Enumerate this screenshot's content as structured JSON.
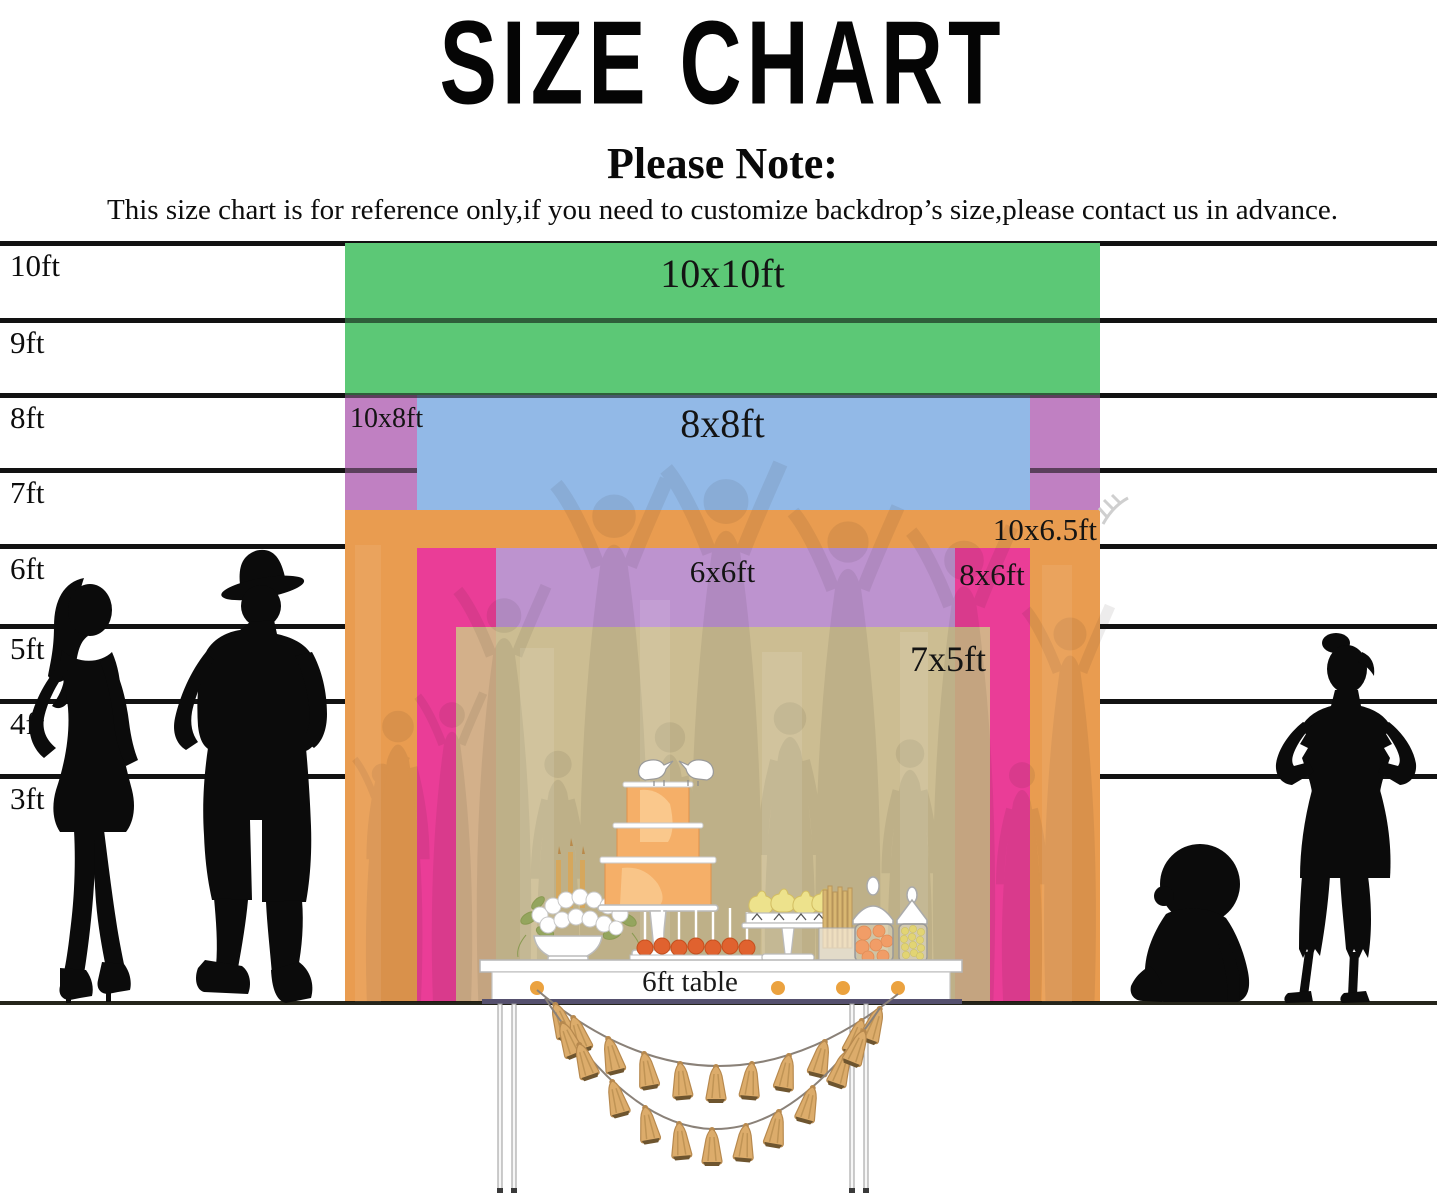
{
  "title": "SIZE CHART",
  "note": {
    "heading": "Please Note:",
    "body": "This size chart is for reference only,if you need to customize backdrop’s size,please contact us in advance."
  },
  "ruler": {
    "unit": "ft",
    "labels": [
      "10ft",
      "9ft",
      "8ft",
      "7ft",
      "6ft",
      "5ft",
      "4ft",
      "3ft"
    ]
  },
  "backdrops": {
    "size_10x10": {
      "label": "10x10ft",
      "width_ft": 10,
      "height_ft": 10,
      "color": "#5CC876"
    },
    "size_10x8": {
      "label": "10x8ft",
      "width_ft": 10,
      "height_ft": 8,
      "color": "#C080C2"
    },
    "size_8x8": {
      "label": "8x8ft",
      "width_ft": 8,
      "height_ft": 8,
      "color": "#92B9E7"
    },
    "size_10x65": {
      "label": "10x6.5ft",
      "width_ft": 10,
      "height_ft": 6.5,
      "color": "#E99C50"
    },
    "size_8x6": {
      "label": "8x6ft",
      "width_ft": 8,
      "height_ft": 6,
      "color": "#EA3D97"
    },
    "size_6x6": {
      "label": "6x6ft",
      "width_ft": 6,
      "height_ft": 6,
      "color": "#BD93CF"
    },
    "size_7x5": {
      "label": "7x5ft",
      "width_ft": 7,
      "height_ft": 5,
      "color": "#CFC487"
    }
  },
  "table": {
    "label": "6ft table"
  }
}
